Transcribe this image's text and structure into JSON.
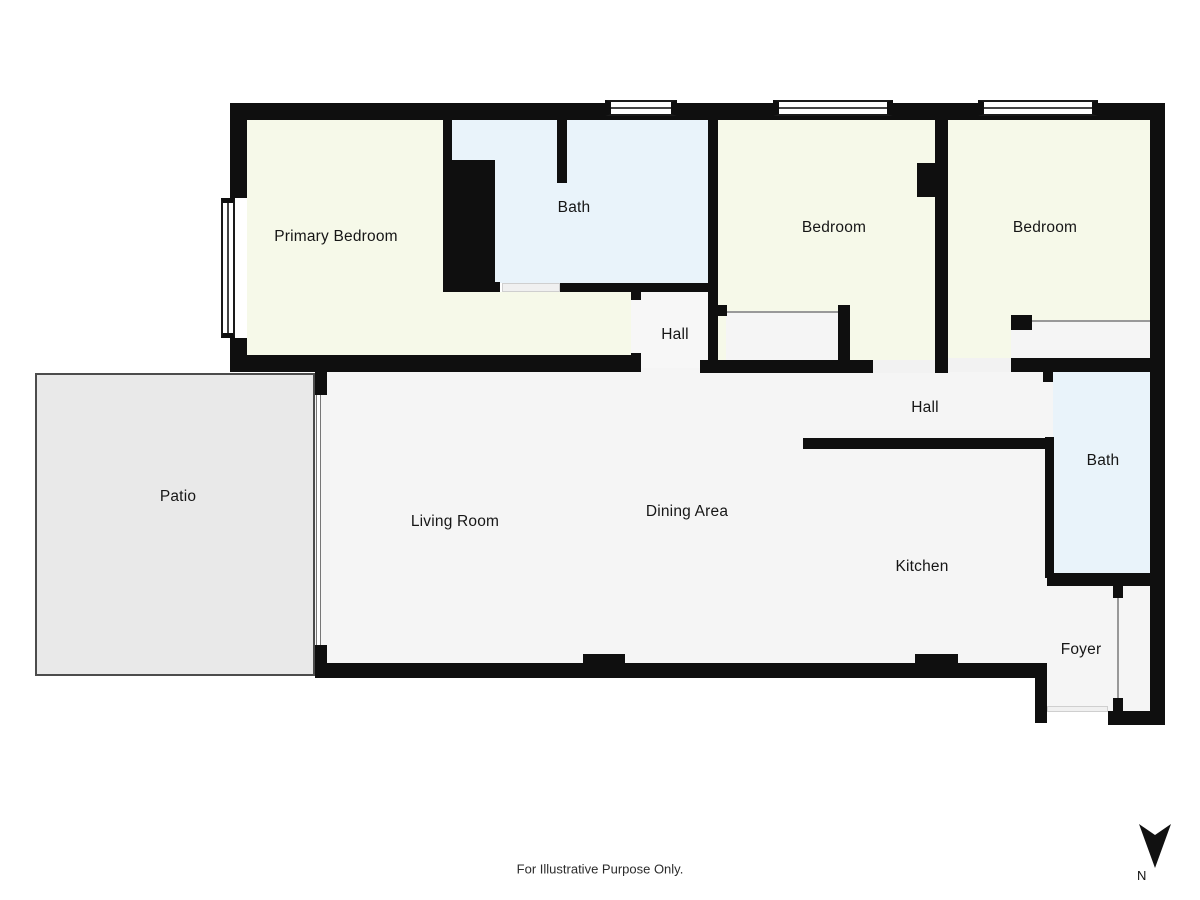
{
  "title": "Floor plan",
  "rooms": {
    "primary_bedroom": {
      "label": "Primary Bedroom"
    },
    "bath_top": {
      "label": "Bath"
    },
    "bedroom_mid": {
      "label": "Bedroom"
    },
    "bedroom_right": {
      "label": "Bedroom"
    },
    "hall_top": {
      "label": "Hall"
    },
    "hall_right": {
      "label": "Hall"
    },
    "bath_right": {
      "label": "Bath"
    },
    "patio": {
      "label": "Patio"
    },
    "living_room": {
      "label": "Living Room"
    },
    "dining_area": {
      "label": "Dining Area"
    },
    "kitchen": {
      "label": "Kitchen"
    },
    "foyer": {
      "label": "Foyer"
    }
  },
  "footer": {
    "disclaimer": "For Illustrative Purpose Only."
  },
  "compass": {
    "label": "N"
  },
  "colors": {
    "wall": "#0f0f0f",
    "bedroom_fill": "#f6f9e9",
    "bath_fill": "#e9f3fa",
    "floor_fill": "#f5f5f5",
    "patio_fill": "#e9e9e9"
  }
}
